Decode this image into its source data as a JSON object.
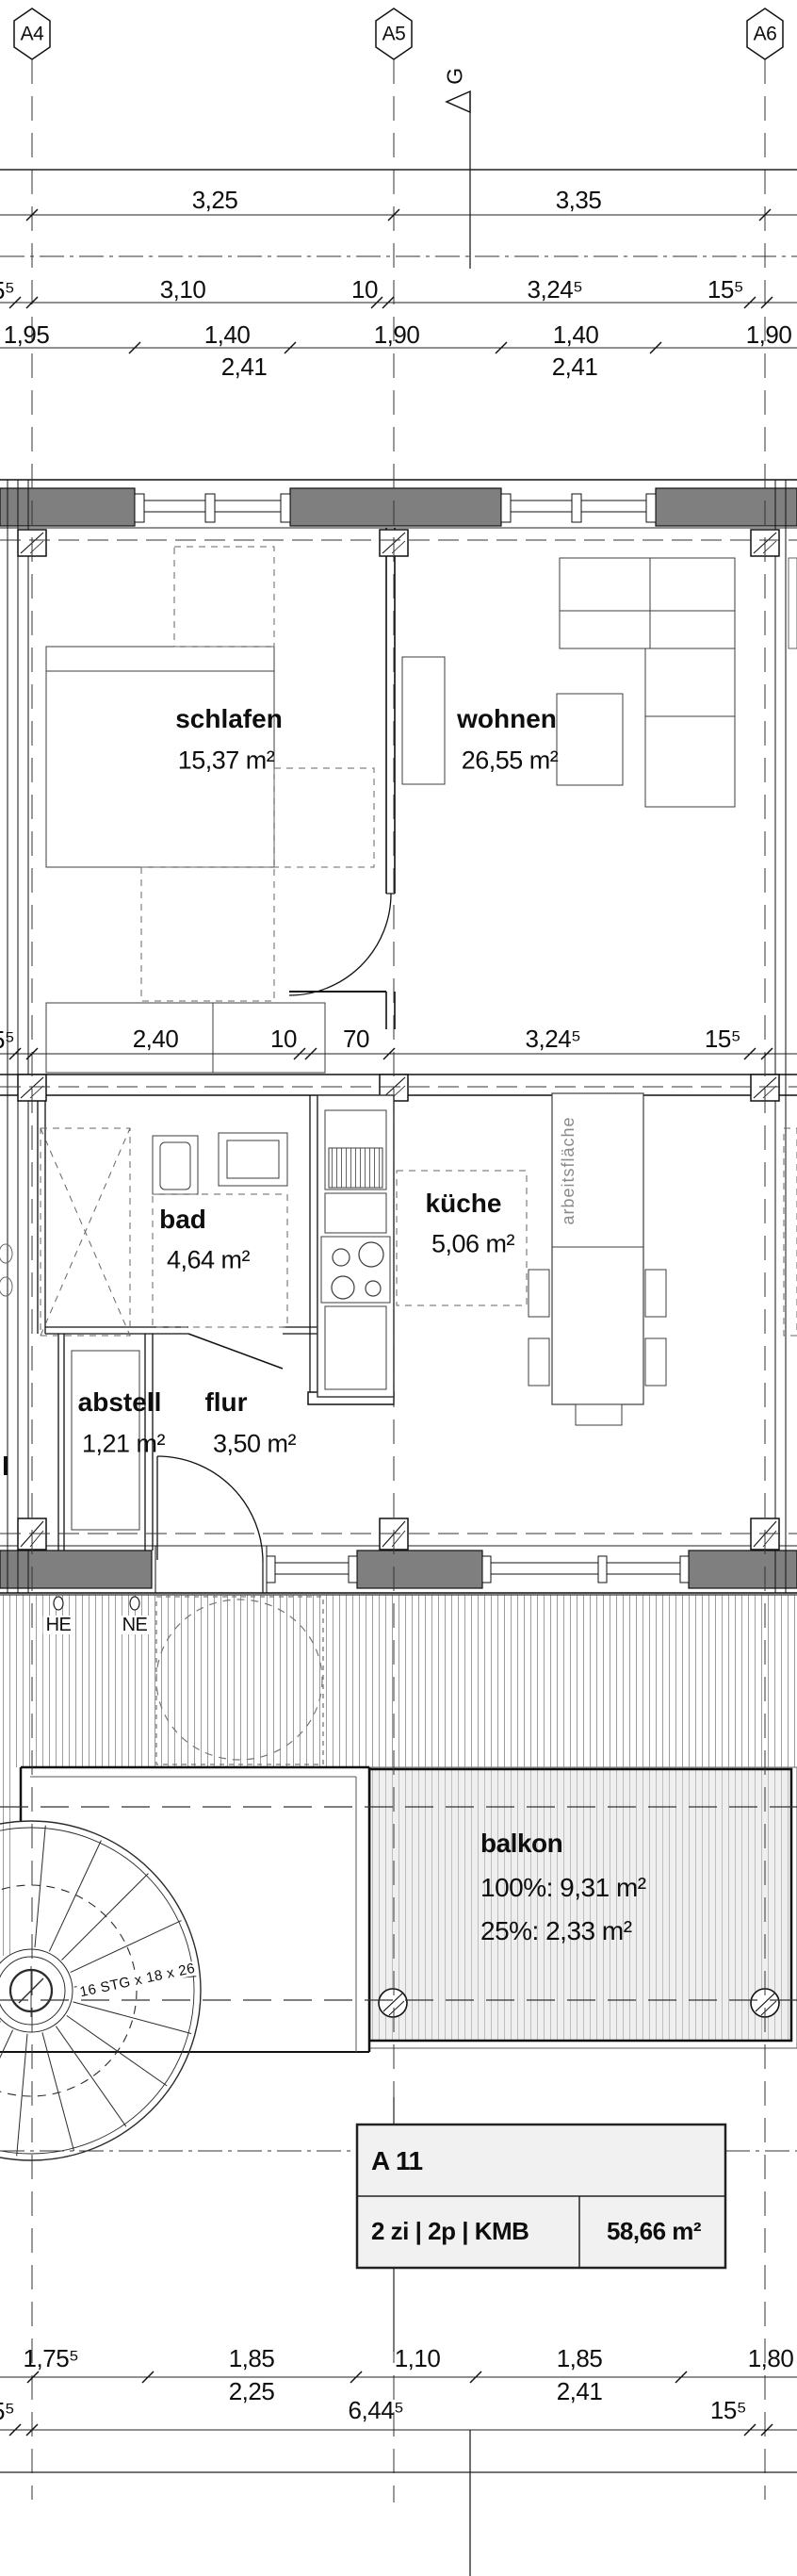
{
  "grid_markers": {
    "a4": "A4",
    "a5": "A5",
    "a6": "A6"
  },
  "section_marker": "G",
  "dimensions": {
    "top_row1": [
      "3,25",
      "3,35"
    ],
    "top_row2": [
      "5⁵",
      "3,10",
      "10",
      "3,24⁵",
      "15⁵"
    ],
    "top_row3": [
      "1,95",
      "1,40",
      "1,90",
      "1,40",
      "1,90"
    ],
    "top_row4": [
      "2,41",
      "2,41"
    ],
    "mid_row": [
      "5⁵",
      "2,40",
      "10",
      "70",
      "3,24⁵",
      "15⁵"
    ],
    "bottom_row1": [
      "1,75⁵",
      "1,85",
      "1,10",
      "1,85",
      "1,80"
    ],
    "bottom_row1b": [
      "2,25",
      "2,41"
    ],
    "bottom_row2": [
      "5⁵",
      "6,44⁵",
      "15⁵"
    ]
  },
  "rooms": {
    "schlafen": {
      "name": "schlafen",
      "area": "15,37 m²"
    },
    "wohnen": {
      "name": "wohnen",
      "area": "26,55 m²"
    },
    "bad": {
      "name": "bad",
      "area": "4,64 m²"
    },
    "kueche": {
      "name": "küche",
      "area": "5,06 m²"
    },
    "abstell": {
      "name": "abstell",
      "area": "1,21 m²"
    },
    "flur": {
      "name": "flur",
      "area": "3,50 m²"
    },
    "balkon": {
      "name": "balkon",
      "area_full": "100%: 9,31 m²",
      "area_partial": "25%: 2,33 m²"
    }
  },
  "annotations": {
    "worktop": "arbeitsfläche",
    "meter_he": "HE",
    "meter_ne": "NE",
    "stair_note": "16 STG x 18 x 26",
    "left_fragment": "l"
  },
  "title_block": {
    "unit_id": "A 11",
    "unit_config": "2 zi | 2p | KMB",
    "unit_area": "58,66 m²"
  },
  "colors": {
    "wall_fill": "#7f7f7f",
    "line": "#1a1a1a",
    "titleblock_fill": "#f1f1f1",
    "worktop_text": "#8a8a8a"
  }
}
